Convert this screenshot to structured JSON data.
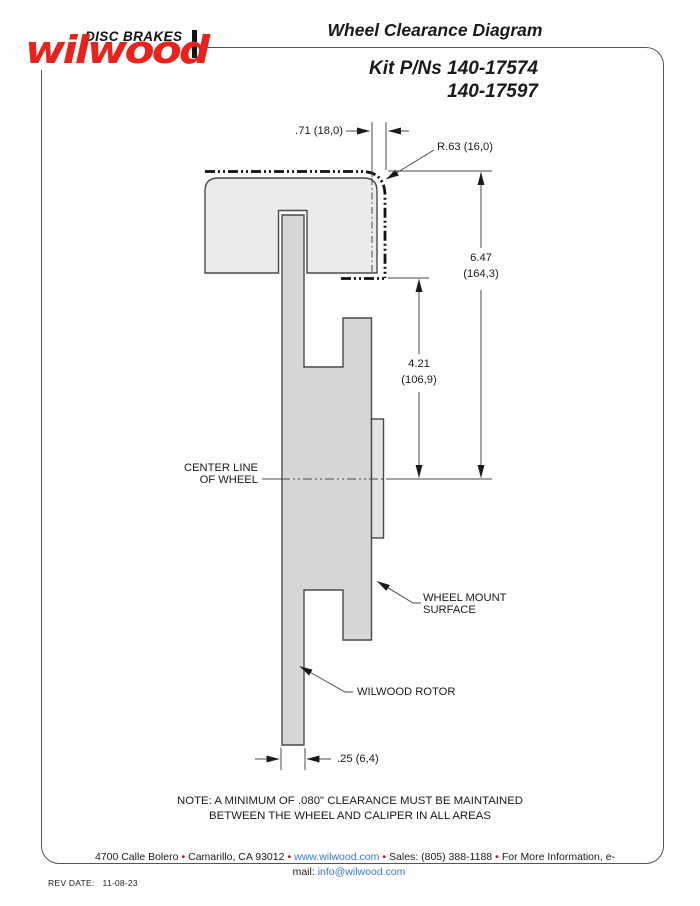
{
  "logo": {
    "brand": "wilwood",
    "tagline": "DISC BRAKES",
    "brand_color": "#e8231d"
  },
  "header": {
    "title": "Wheel Clearance Diagram",
    "subtitle_line1": "Kit P/Ns 140-17574",
    "subtitle_line2": "140-17597"
  },
  "diagram": {
    "dim_top_width": ".71 (18,0)",
    "dim_corner_radius": "R.63 (16,0)",
    "dim_outer_depth": {
      "line1": "6.47",
      "line2": "(164,3)"
    },
    "dim_inner_depth": {
      "line1": "4.21",
      "line2": "(106,9)"
    },
    "centerline_label": {
      "line1": "CENTER LINE",
      "line2": "OF WHEEL"
    },
    "wheel_mount_label": {
      "line1": "WHEEL MOUNT",
      "line2": "SURFACE"
    },
    "rotor_label": "WILWOOD ROTOR",
    "dim_rotor_width": ".25 (6,4)"
  },
  "note": {
    "line1": "NOTE: A MINIMUM OF .080\" CLEARANCE MUST BE MAINTAINED",
    "line2": "BETWEEN THE WHEEL AND CALIPER IN ALL AREAS"
  },
  "footer": {
    "bullet": "•",
    "address1": "4700 Calle Bolero",
    "address2": "Camarillo, CA 93012",
    "website": "www.wilwood.com",
    "sales": "Sales: (805) 388-1188",
    "info_label": "For More Information, e-mail:",
    "email": "info@wilwood.com",
    "bullet_color": "#d0021b",
    "link_color": "#3579cc"
  },
  "rev": {
    "label": "REV DATE:",
    "value": "11-08-23"
  }
}
